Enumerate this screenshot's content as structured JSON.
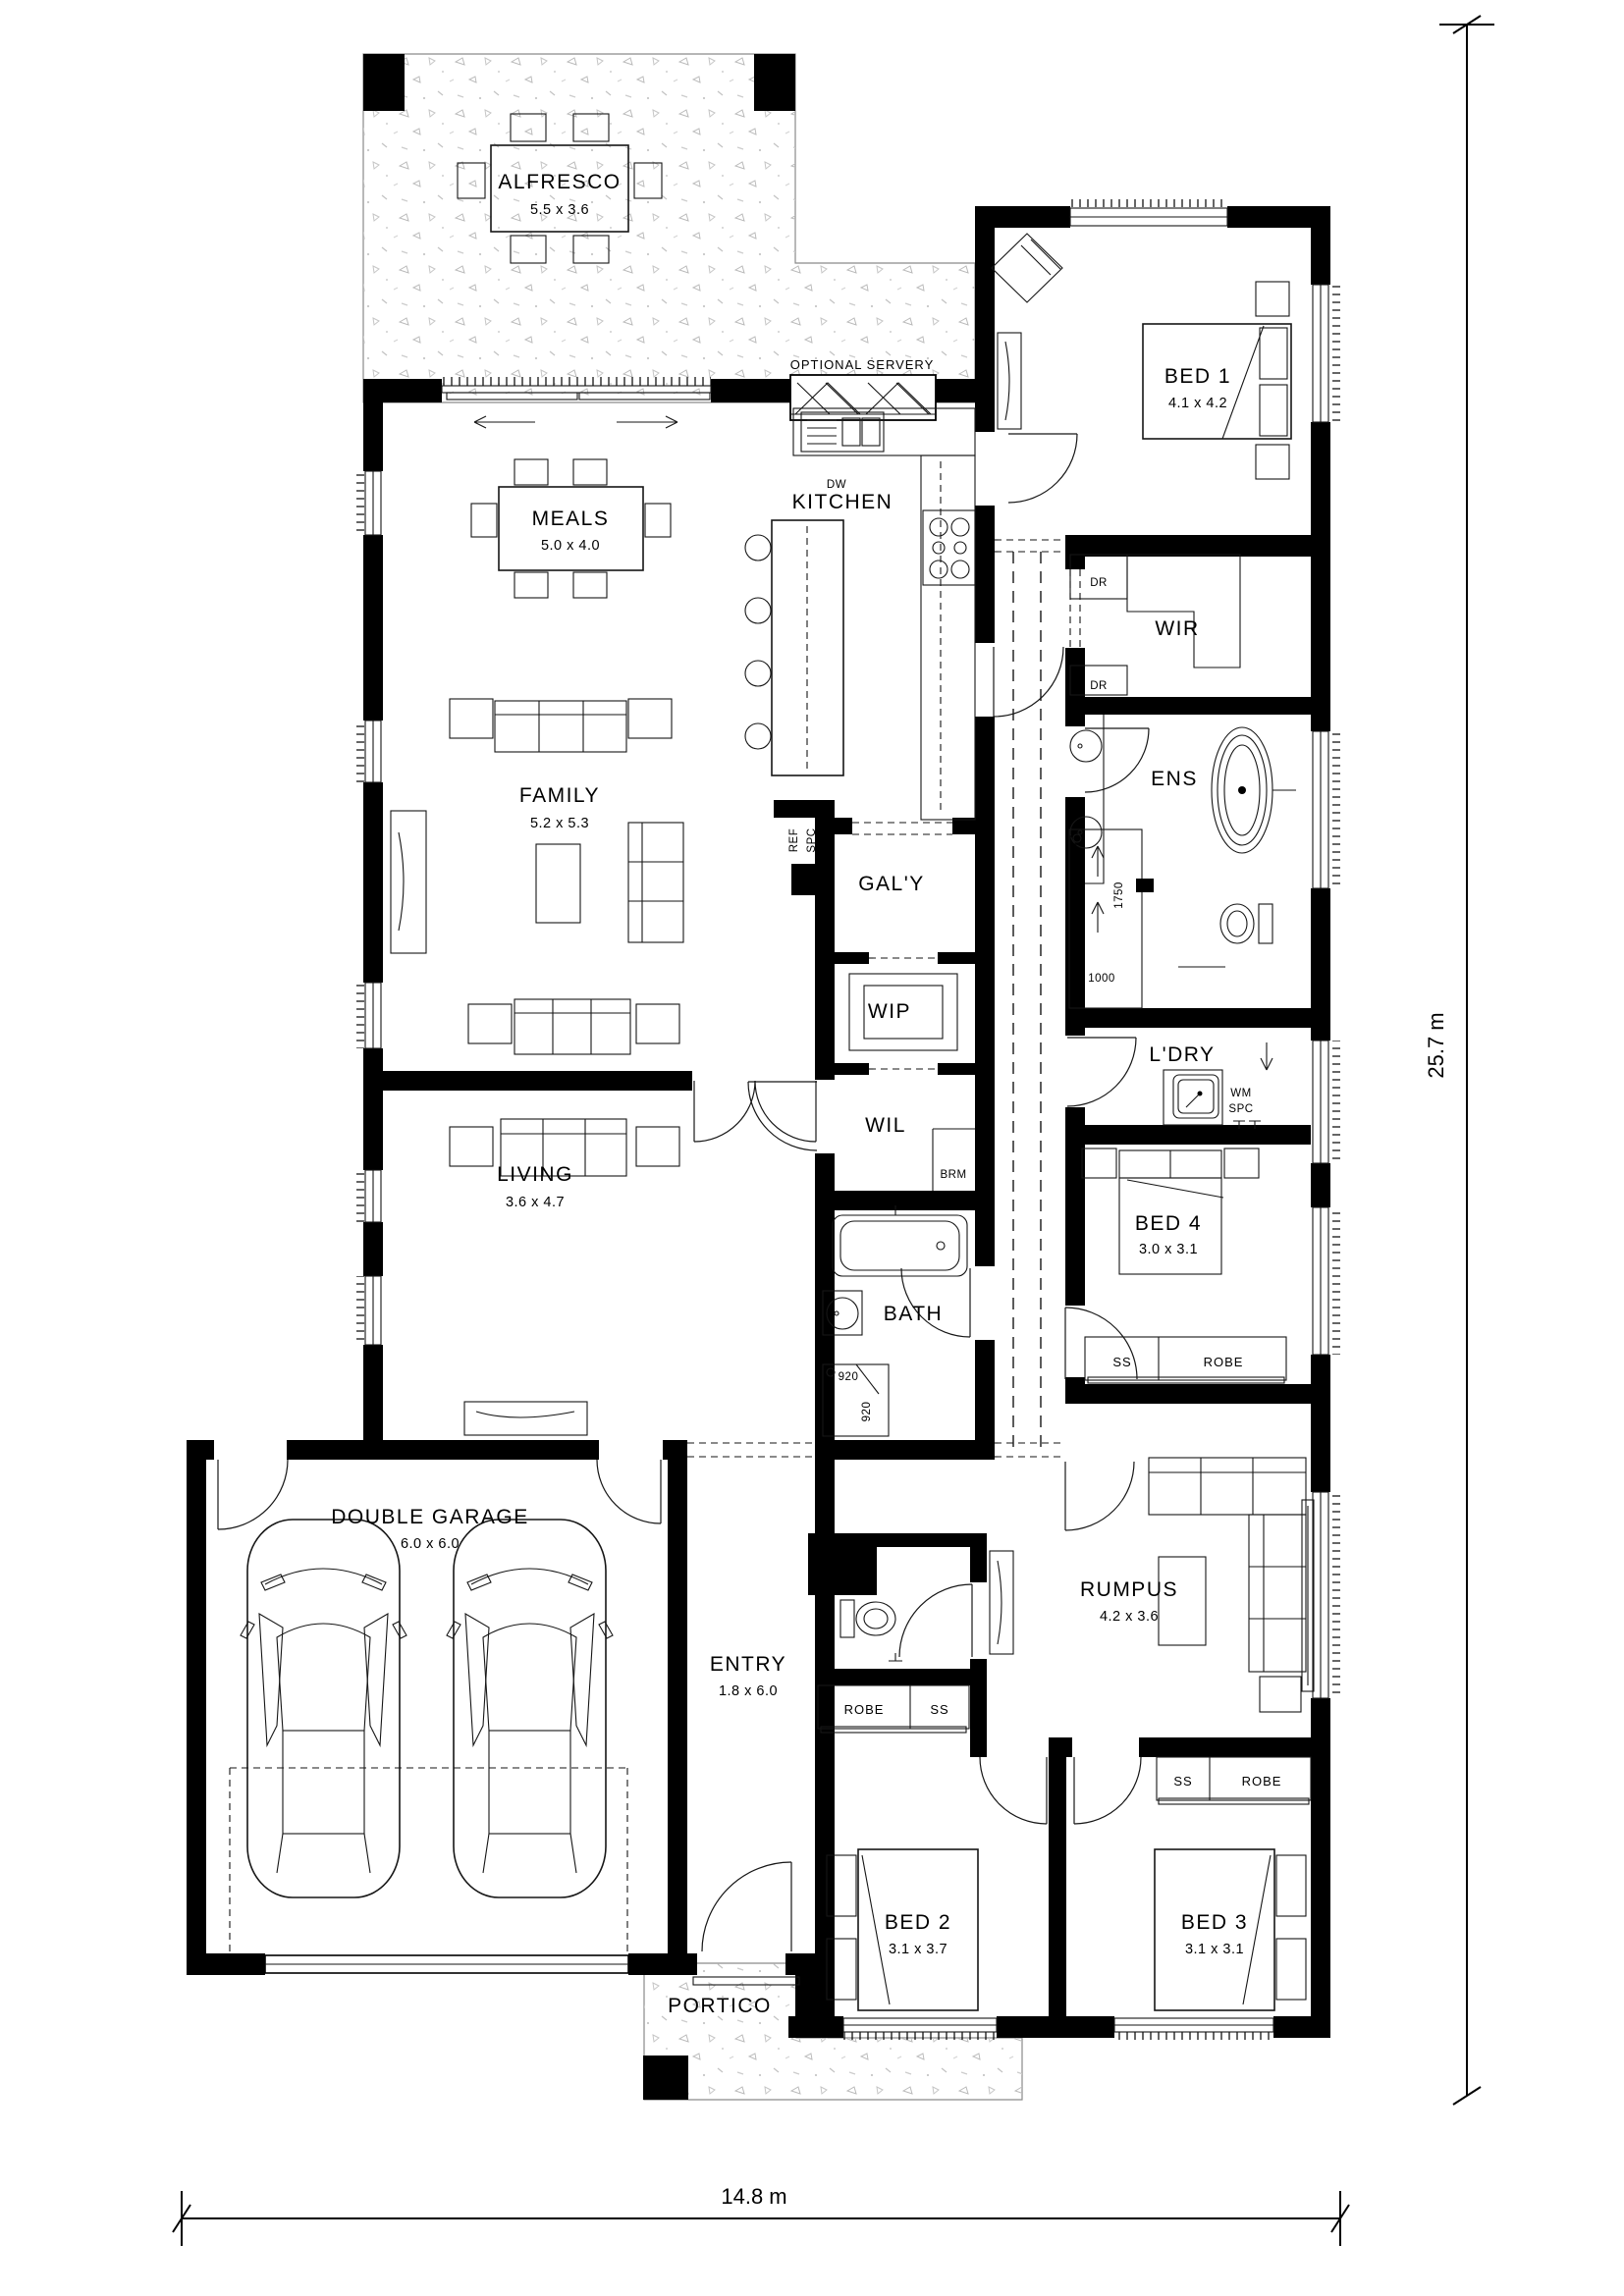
{
  "rooms": {
    "alfresco": {
      "label": "ALFRESCO",
      "dims": "5.5 x 3.6"
    },
    "meals": {
      "label": "MEALS",
      "dims": "5.0 x 4.0"
    },
    "kitchen": {
      "label": "KITCHEN"
    },
    "family": {
      "label": "FAMILY",
      "dims": "5.2 x 5.3"
    },
    "living": {
      "label": "LIVING",
      "dims": "3.6 x 4.7"
    },
    "bed1": {
      "label": "BED 1",
      "dims": "4.1 x 4.2"
    },
    "wir": {
      "label": "WIR"
    },
    "ens": {
      "label": "ENS"
    },
    "galley": {
      "label": "GAL'Y"
    },
    "wip": {
      "label": "WIP"
    },
    "wil": {
      "label": "WIL"
    },
    "brm": {
      "label": "BRM"
    },
    "laundry": {
      "label": "L'DRY"
    },
    "bed4": {
      "label": "BED 4",
      "dims": "3.0 x 3.1"
    },
    "bath": {
      "label": "BATH"
    },
    "garage": {
      "label": "DOUBLE GARAGE",
      "dims": "6.0 x 6.0"
    },
    "entry": {
      "label": "ENTRY",
      "dims": "1.8 x 6.0"
    },
    "rumpus": {
      "label": "RUMPUS",
      "dims": "4.2 x 3.6"
    },
    "bed2": {
      "label": "BED 2",
      "dims": "3.1 x 3.7"
    },
    "bed3": {
      "label": "BED 3",
      "dims": "3.1 x 3.1"
    },
    "portico": {
      "label": "PORTICO"
    }
  },
  "annotations": {
    "optional_servery": "OPTIONAL SERVERY",
    "dw": "DW",
    "ref_line1": "REF",
    "ref_line2": "SPC",
    "dr_top": "DR",
    "dr_bottom": "DR",
    "wm_line1": "WM",
    "wm_line2": "SPC",
    "shower_width": "1750",
    "shower_depth": "1000",
    "bath_shower_w": "920",
    "bath_shower_d": "920",
    "bed4_ss": "SS",
    "bed4_robe": "ROBE",
    "entry_robe": "ROBE",
    "entry_ss": "SS",
    "bed3_ss": "SS",
    "bed3_robe": "ROBE"
  },
  "dimensions": {
    "overall_width": "14.8 m",
    "overall_depth": "25.7 m"
  },
  "colors": {
    "walls": "#000000",
    "lines": "#161616",
    "speckle": "#b9b9b9",
    "background": "#ffffff"
  }
}
